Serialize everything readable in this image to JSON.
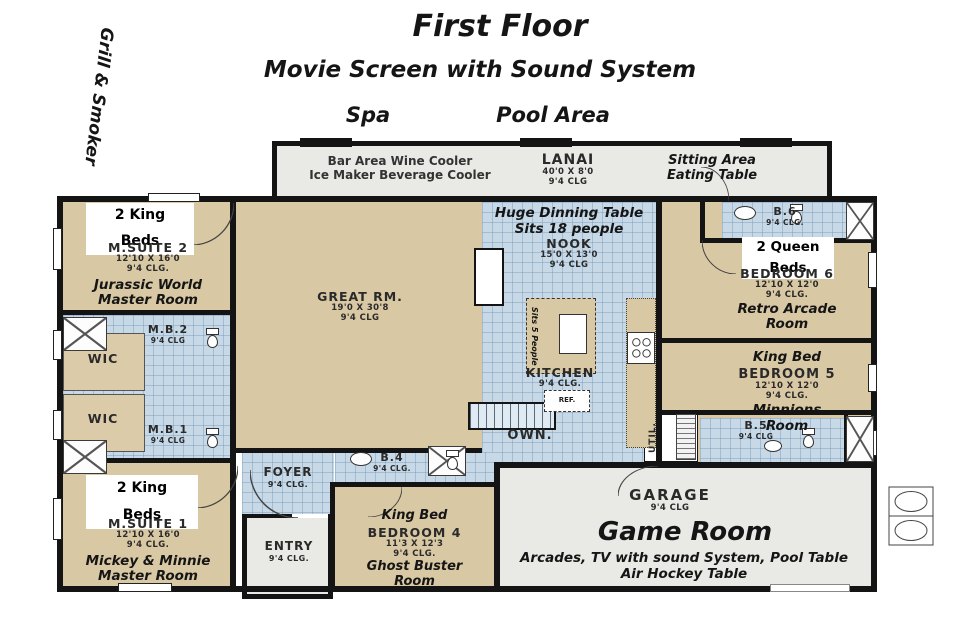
{
  "colors": {
    "tan": "#d9c8a4",
    "tile": "#c7d8e6",
    "gray": "#e9e9e6",
    "wall": "#141414"
  },
  "titles": {
    "main": "First Floor",
    "subtitle": "Movie Screen with Sound System",
    "spa": "Spa",
    "pool_area": "Pool Area",
    "grill_smoker": "Grill & Smoker"
  },
  "lanai": {
    "bar_line1": "Bar Area Wine Cooler",
    "bar_line2": "Ice Maker Beverage Cooler",
    "name": "LANAI",
    "dims": "40'0 X 8'0",
    "clg": "9'4 CLG",
    "sitting_line1": "Sitting Area",
    "sitting_line2": "Eating Table"
  },
  "msuite2": {
    "beds_line1": "2 King",
    "beds_line2": "Beds",
    "name": "M.SUITE 2",
    "dims": "12'10 X 16'0",
    "clg": "9'4 CLG.",
    "theme_line1": "Jurassic World",
    "theme_line2": "Master Room"
  },
  "mb2": {
    "name": "M.B.2",
    "clg": "9'4 CLG"
  },
  "wic_top": {
    "name": "WIC"
  },
  "wic_bottom": {
    "name": "WIC"
  },
  "mb1": {
    "name": "M.B.1",
    "clg": "9'4 CLG"
  },
  "msuite1": {
    "beds_line1": "2 King",
    "beds_line2": "Beds",
    "name": "M.SUITE 1",
    "dims": "12'10 X 16'0",
    "clg": "9'4 CLG.",
    "theme_line1": "Mickey & Minnie",
    "theme_line2": "Master Room"
  },
  "great_room": {
    "name": "GREAT RM.",
    "dims": "19'0 X 30'8",
    "clg": "9'4 CLG"
  },
  "nook": {
    "note_line1": "Huge Dinning Table",
    "note_line2": "Sits 18 people",
    "name": "NOOK",
    "dims": "15'0 X 13'0",
    "clg": "9'4 CLG"
  },
  "island": {
    "note": "Sits 5 People"
  },
  "kitchen": {
    "name": "KITCHEN",
    "clg": "9'4 CLG.",
    "ref": "REF."
  },
  "stairs": {
    "label": "OWN."
  },
  "foyer": {
    "name": "FOYER",
    "clg": "9'4 CLG."
  },
  "b4": {
    "name": "B.4",
    "clg": "9'4 CLG."
  },
  "entry": {
    "name": "ENTRY",
    "clg": "9'4 CLG."
  },
  "bedroom4": {
    "bed": "King Bed",
    "name": "BEDROOM 4",
    "dims": "11'3 X 12'3",
    "clg": "9'4 CLG.",
    "theme_line1": "Ghost Buster",
    "theme_line2": "Room"
  },
  "b6": {
    "name": "B.6",
    "clg": "9'4 CLG."
  },
  "bedroom6": {
    "beds_line1": "2 Queen",
    "beds_line2": "Beds",
    "name": "BEDROOM 6",
    "dims": "12'10 X 12'0",
    "clg": "9'4 CLG.",
    "theme_line1": "Retro Arcade",
    "theme_line2": "Room"
  },
  "bedroom5": {
    "bed": "King Bed",
    "name": "BEDROOM 5",
    "dims": "12'10 X 12'0",
    "clg": "9'4 CLG.",
    "theme_line1": "Minnions",
    "theme_line2": "Room"
  },
  "b5": {
    "name": "B.5",
    "clg": "9'4 CLG"
  },
  "util": {
    "name": "UTIL."
  },
  "garage": {
    "name": "GARAGE",
    "clg": "9'4 CLG"
  },
  "game_room": {
    "name": "Game Room",
    "note_line1": "Arcades, TV with sound System, Pool Table",
    "note_line2": "Air Hockey Table"
  }
}
